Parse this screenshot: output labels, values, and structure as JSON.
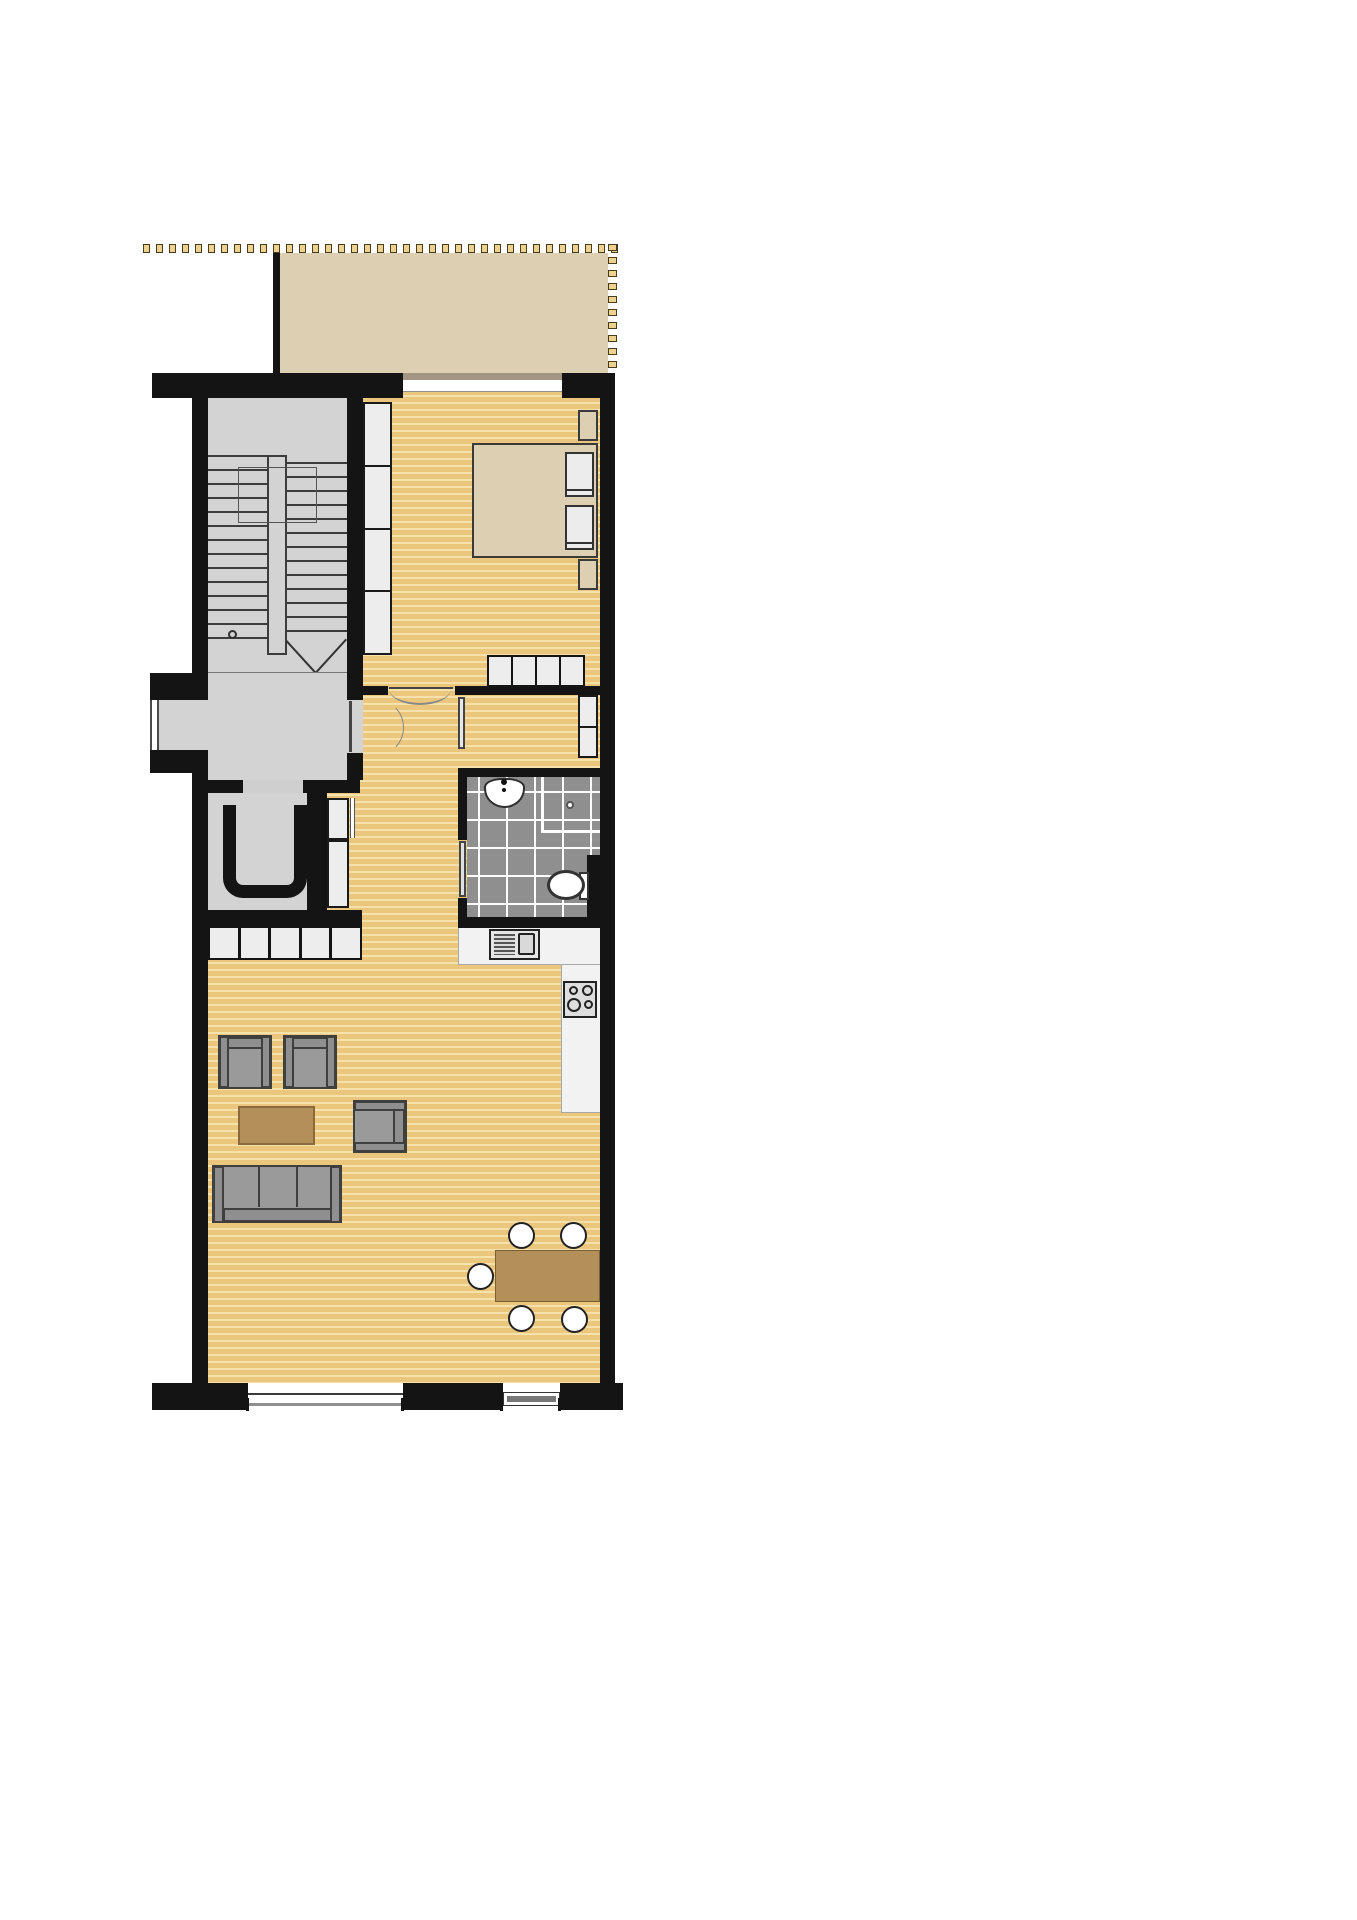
{
  "document": {
    "type": "architectural-floor-plan",
    "title": "apartment-floor-plan",
    "visible_text": "",
    "background": "#ffffff"
  },
  "colors": {
    "wall": "#141414",
    "wood_floor_base": "#eac77d",
    "wood_floor_stripe": "#f5e1ab",
    "balcony_floor": "#ddcfb1",
    "common_area_floor": "#d3d3d3",
    "bathroom_tile": "#8f8f8f",
    "tile_grout": "#fdfdfd",
    "railing_square_fill": "#ecd28e",
    "railing_square_border": "#473c1e",
    "closet_panel": "#ededed",
    "kitchen_counter": "#f2f2f2",
    "furniture_gray": "#9a9a9a",
    "furniture_outline": "#3f3f3f",
    "table_wood": "#b3905a",
    "sliding_door_track": "#a39584"
  },
  "rooms": [
    {
      "name": "balcony",
      "floor": "beige",
      "features": [
        "dashed-railing-top",
        "dashed-railing-right",
        "sliding-door"
      ]
    },
    {
      "name": "bedroom",
      "floor": "wood",
      "features": [
        "bed",
        "two-pillows",
        "two-nightstands",
        "wardrobe-column",
        "low-cabinet-row"
      ]
    },
    {
      "name": "stairwell",
      "floor": "gray",
      "features": [
        "two-stair-flights",
        "center-spine",
        "down-arrow"
      ]
    },
    {
      "name": "entrance-hall",
      "floor": "gray",
      "features": [
        "building-entrance-door",
        "apartment-entrance-door"
      ]
    },
    {
      "name": "elevator-room",
      "floor": "gray",
      "features": [
        "elevator-car-symbol",
        "door-opening"
      ]
    },
    {
      "name": "hallway",
      "floor": "wood",
      "features": [
        "tall-cabinet",
        "bedroom-door",
        "dressing-door"
      ]
    },
    {
      "name": "dressing-corridor",
      "floor": "wood",
      "features": [
        "wardrobe-panels"
      ]
    },
    {
      "name": "bathroom",
      "floor": "tile",
      "features": [
        "sink",
        "toilet",
        "shower-corner",
        "door"
      ]
    },
    {
      "name": "kitchen",
      "floor": "wood",
      "features": [
        "l-shaped-counter",
        "sink-unit",
        "hob-4-burners"
      ]
    },
    {
      "name": "living-room",
      "floor": "wood",
      "features": [
        "sideboard-row",
        "two-armchairs",
        "coffee-table",
        "side-armchair",
        "sofa"
      ]
    },
    {
      "name": "dining-area",
      "floor": "wood",
      "features": [
        "dining-table",
        "five-chairs"
      ]
    }
  ],
  "fixtures": {
    "railing_top_dash_count": 37,
    "railing_side_dash_count": 10,
    "stair_flights": 2,
    "stair_treads_per_flight": 13,
    "wardrobe_bedroom_panels": 4,
    "hall_cabinet_panels": 2,
    "dressing_wardrobe_panels": 2,
    "bedroom_low_cabinet_panels": 4,
    "sideboard_panels": 5,
    "hob_burners": 4,
    "dining_chairs": 5,
    "bed_pillows": 2,
    "nightstands": 2,
    "bottom_windows": 2
  }
}
